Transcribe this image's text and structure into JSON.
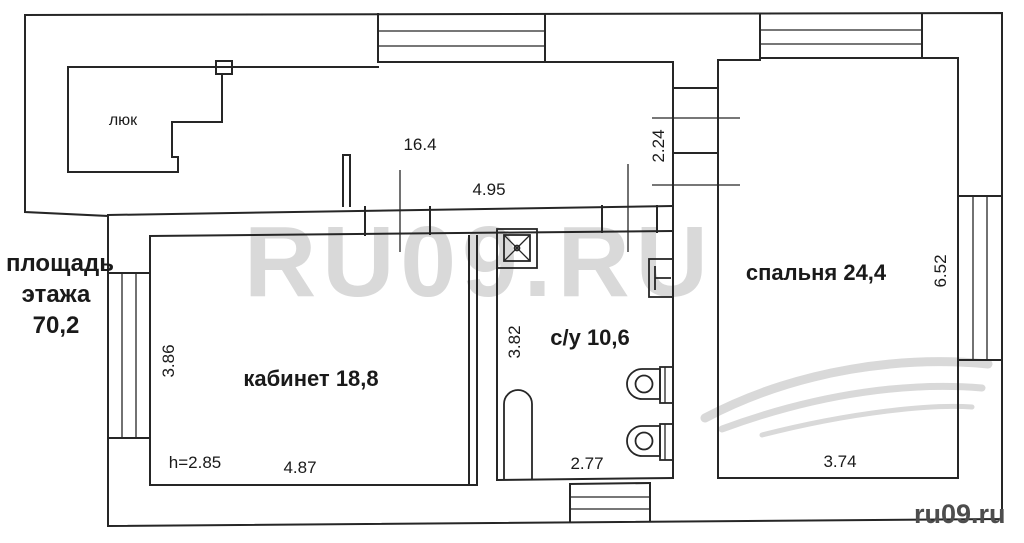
{
  "labels": {
    "floor_area_line1": "площадь",
    "floor_area_line2": "этажа",
    "floor_area_line3": "70,2",
    "hatch": "люк",
    "dim_hall_area": "16.4",
    "dim_hall_width": "4.95",
    "dim_corridor": "2.24",
    "office": "кабинет 18,8",
    "dim_office_depth": "3.86",
    "ceiling_height": "h=2.85",
    "dim_office_width": "4.87",
    "bathroom": "с/у 10,6",
    "dim_bath_depth": "3.82",
    "dim_bath_width": "2.77",
    "bedroom": "спальня 24,4",
    "dim_bedroom_depth": "6.52",
    "dim_bedroom_width": "3.74"
  },
  "watermark": {
    "center": "RU09.RU",
    "corner": "ru09.ru"
  },
  "colors": {
    "background": "#ffffff",
    "wall_line": "#262626",
    "label_text": "#1a1a1a",
    "watermark_light": "#d9d9d9",
    "watermark_dark": "#4d4d4d"
  }
}
